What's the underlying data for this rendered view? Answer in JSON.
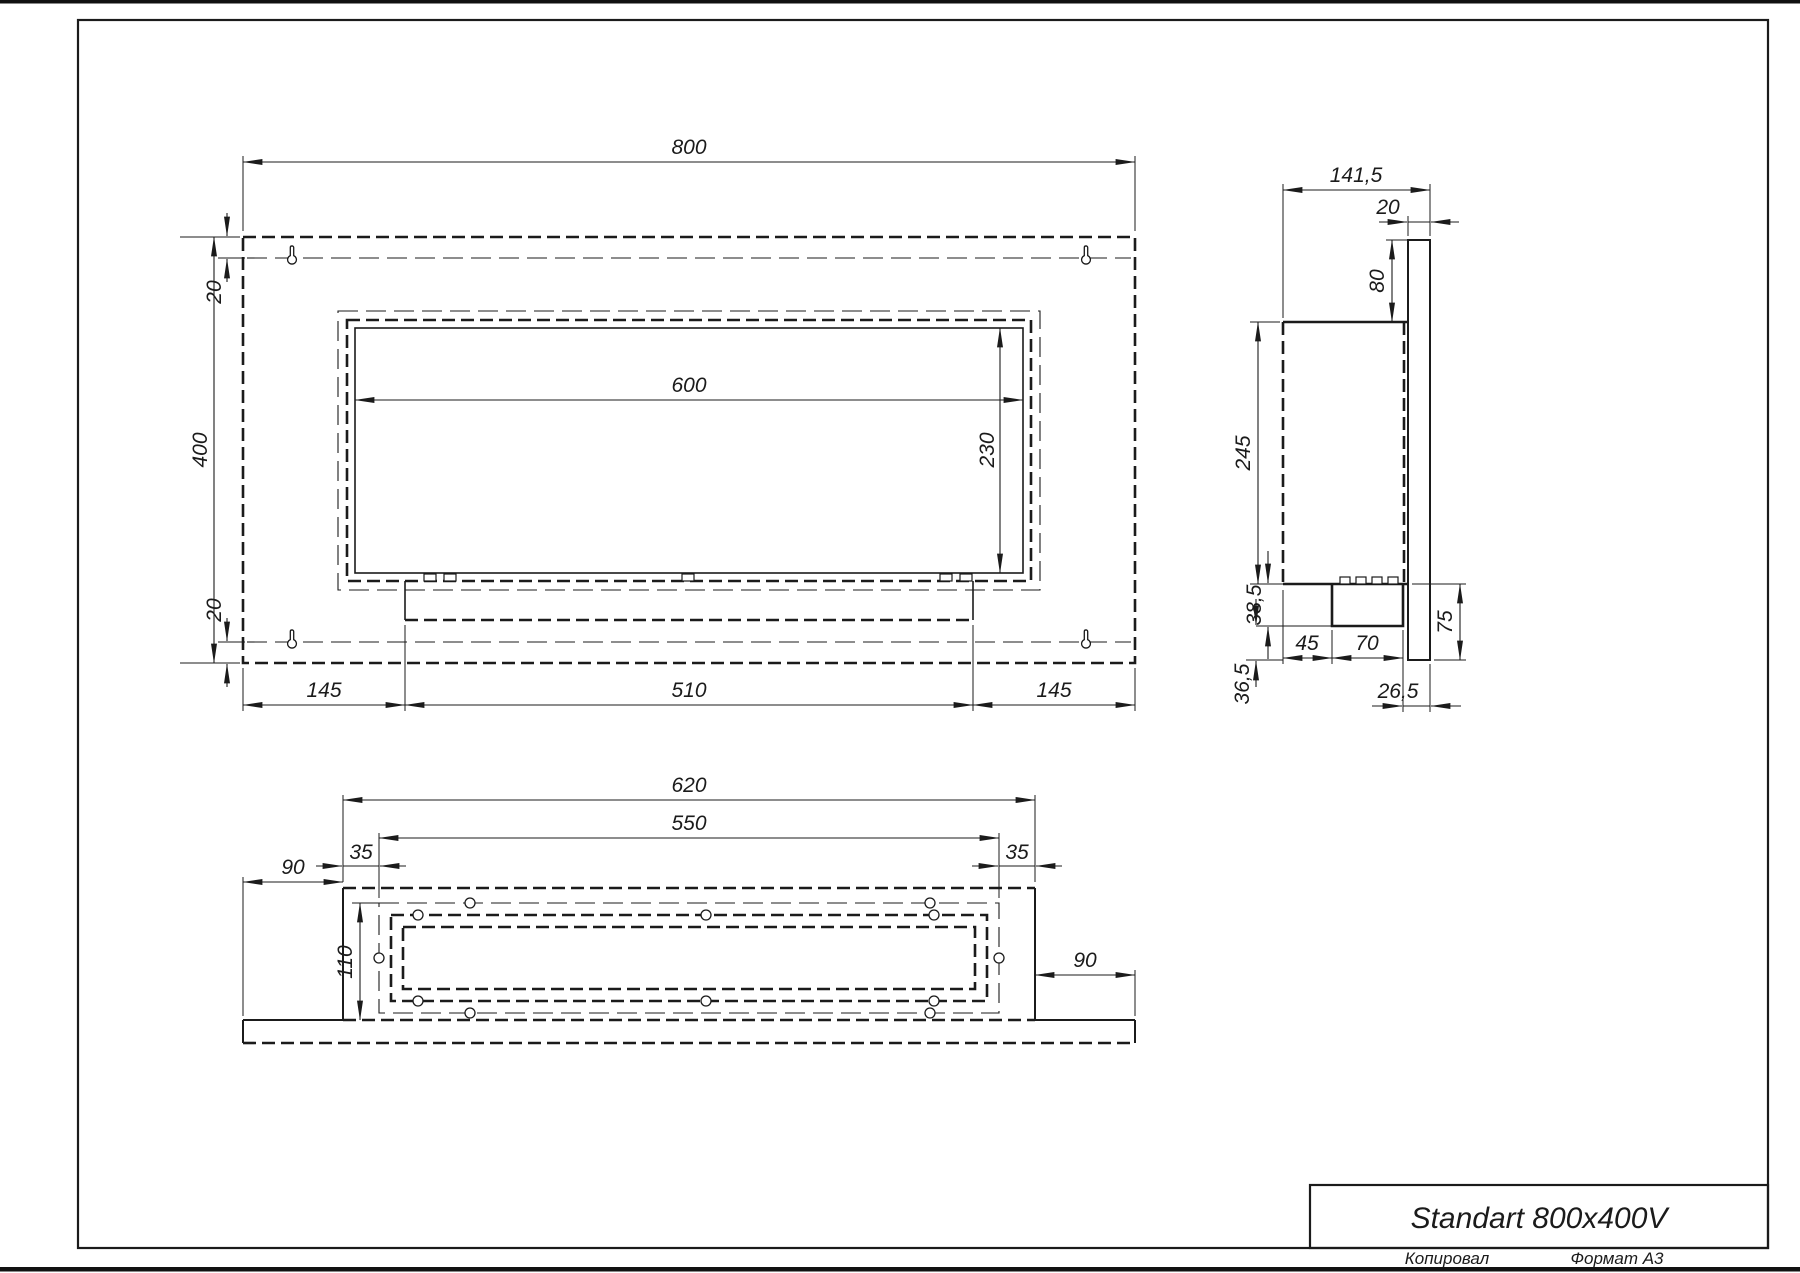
{
  "front_view": {
    "dim_800": "800",
    "dim_400": "400",
    "dim_20_top": "20",
    "dim_20_bottom": "20",
    "dim_600": "600",
    "dim_230": "230",
    "dim_145_left": "145",
    "dim_510": "510",
    "dim_145_right": "145"
  },
  "side_view": {
    "dim_141_5": "141,5",
    "dim_20": "20",
    "dim_80": "80",
    "dim_245": "245",
    "dim_38_5": "38,5",
    "dim_45": "45",
    "dim_70": "70",
    "dim_36_5": "36,5",
    "dim_26_5": "26,5",
    "dim_75": "75"
  },
  "bottom_view": {
    "dim_620": "620",
    "dim_550": "550",
    "dim_35_left": "35",
    "dim_35_right": "35",
    "dim_90_left": "90",
    "dim_90_right": "90",
    "dim_110": "110"
  },
  "title_block": {
    "title": "Standart 800x400V",
    "copied_label": "Копировал",
    "format_label": "Формат А3"
  },
  "colors": {
    "line": "#1b1b1b",
    "background": "#ffffff"
  }
}
